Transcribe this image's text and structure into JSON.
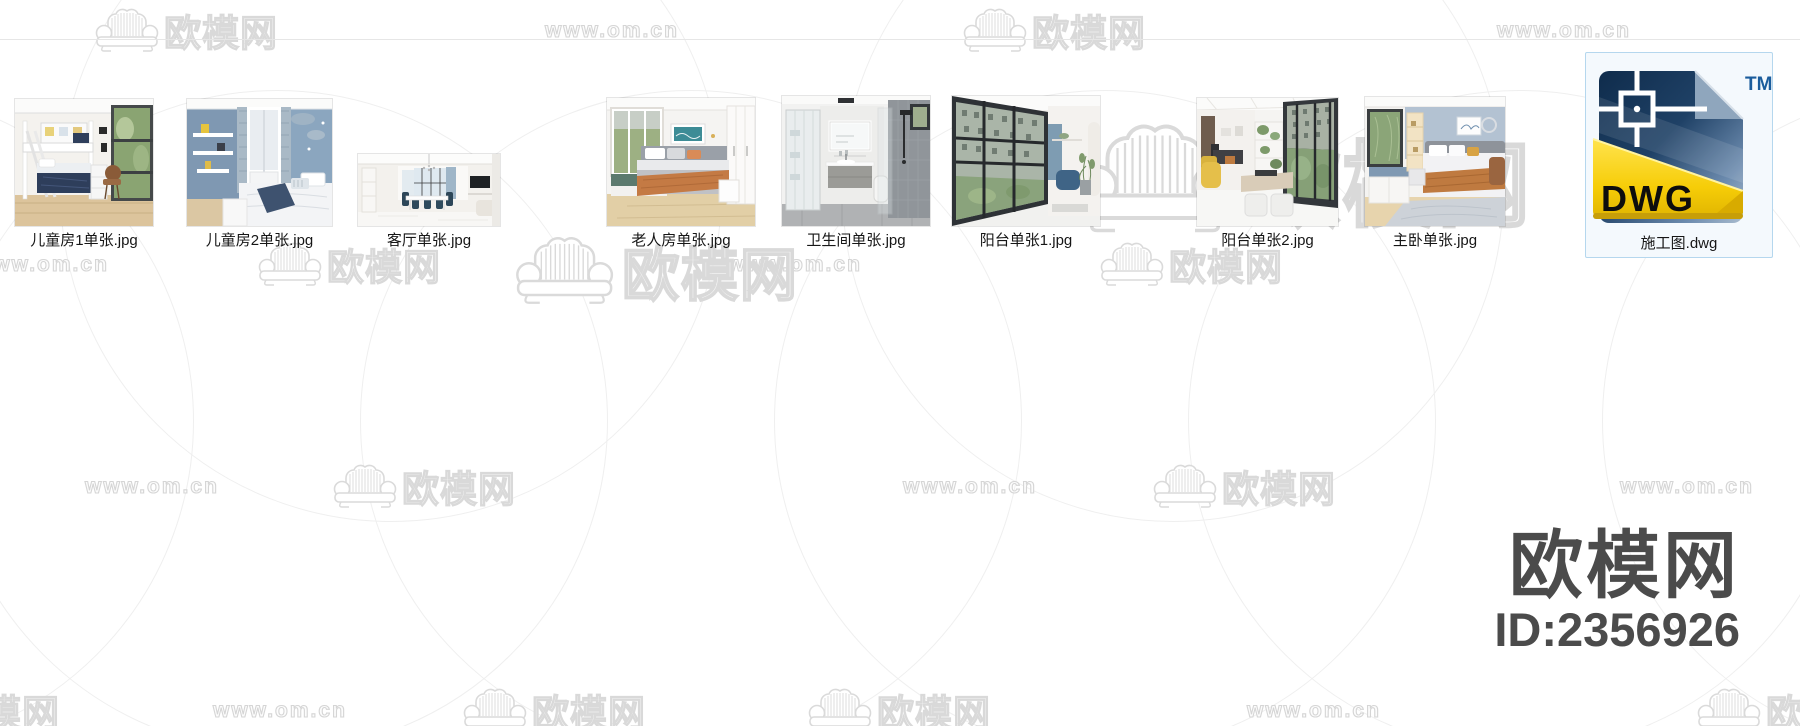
{
  "watermark": {
    "logo_text": "欧模网",
    "url_text": "www.om.cn"
  },
  "brand": {
    "name": "欧模网",
    "id": "ID:2356926"
  },
  "files": [
    {
      "name": "儿童房1单张.jpg",
      "type": "jpg",
      "selected": false
    },
    {
      "name": "儿童房2单张.jpg",
      "type": "jpg",
      "selected": false
    },
    {
      "name": "客厅单张.jpg",
      "type": "jpg",
      "selected": false
    },
    {
      "name": "老人房单张.jpg",
      "type": "jpg",
      "selected": false
    },
    {
      "name": "卫生间单张.jpg",
      "type": "jpg",
      "selected": false
    },
    {
      "name": "阳台单张1.jpg",
      "type": "jpg",
      "selected": false
    },
    {
      "name": "阳台单张2.jpg",
      "type": "jpg",
      "selected": false
    },
    {
      "name": "主卧单张.jpg",
      "type": "jpg",
      "selected": false
    },
    {
      "name": "施工图.dwg",
      "type": "dwg",
      "selected": true
    }
  ],
  "dwg_icon": {
    "label": "DWG",
    "trademark": "TM"
  }
}
